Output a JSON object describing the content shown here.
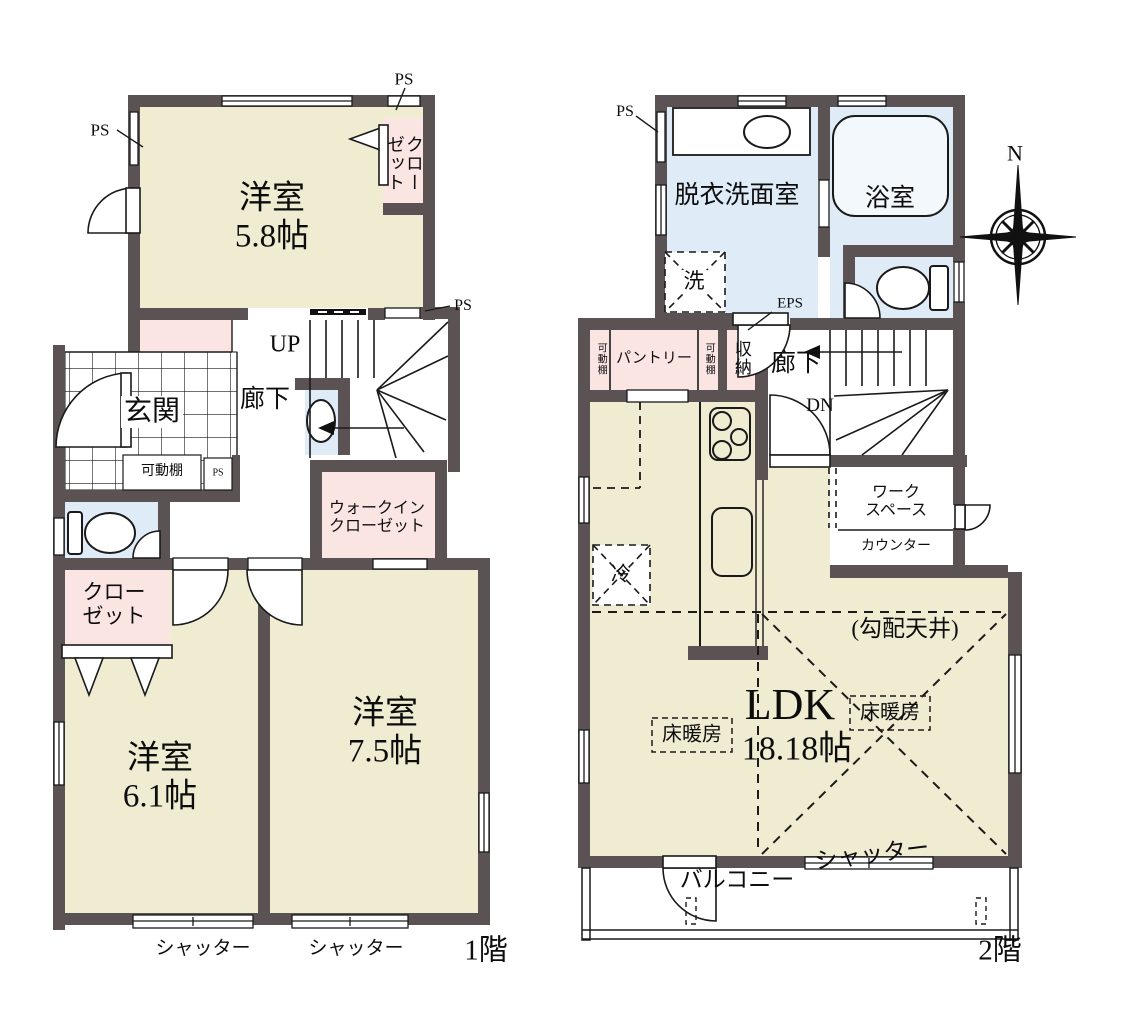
{
  "title": "間取り図",
  "colors": {
    "wall": "#5b5353",
    "room_fill": "#efecd2",
    "closet_fill": "#fbe5e3",
    "wet_area_fill": "#dfecf7",
    "line": "#1a1a1a"
  },
  "compass": {
    "north_label": "N"
  },
  "floor1": {
    "floor_label": "1階",
    "labels": {
      "room_5_8": "洋室\n5.8帖",
      "room_6_1": "洋室\n6.1帖",
      "room_7_5": "洋室\n7.5帖",
      "closet_5_8": "クローゼット",
      "closet_6_1": "クロー\nゼット",
      "walk_in_closet": "ウォークイン\nクローゼット",
      "entrance": "玄関",
      "hallway": "廊下",
      "stairs_up": "UP",
      "movable_shelf": "可動棚",
      "ps_top_left": "PS",
      "ps_top_right": "PS",
      "ps_mid_right": "PS",
      "ps_pipe_small": "PS",
      "shutter_left": "シャッター",
      "shutter_right": "シャッター"
    }
  },
  "floor2": {
    "floor_label": "2階",
    "labels": {
      "washroom": "脱衣洗面室",
      "bathroom": "浴室",
      "laundry": "洗",
      "ps": "PS",
      "eps": "EPS",
      "movable_shelf_left": "可動棚",
      "pantry": "パントリー",
      "movable_shelf_right": "可動棚",
      "storage": "収納",
      "hallway": "廊下",
      "stairs_down": "DN",
      "refrigerator": "冷",
      "workspace": "ワーク\nスペース",
      "counter": "カウンター",
      "ldk_title": "LDK",
      "ldk_size": "18.18帖",
      "sloped_ceiling": "(勾配天井)",
      "floor_heating_left": "床暖房",
      "floor_heating_right": "床暖房",
      "balcony": "バルコニー",
      "shutter": "シャッター"
    }
  }
}
